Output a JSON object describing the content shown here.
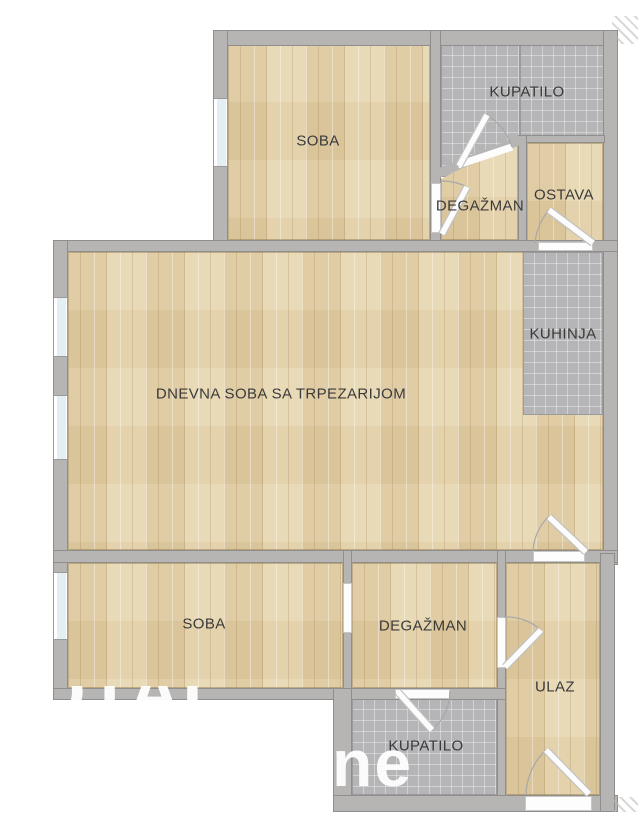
{
  "plan": {
    "rooms": {
      "soba_top": {
        "label": "SOBA"
      },
      "kupatilo_top": {
        "label": "KUPATILO"
      },
      "degazman_top": {
        "label": "DEGAŽMAN"
      },
      "ostava": {
        "label": "OSTAVA"
      },
      "kuhinja": {
        "label": "KUHINJA"
      },
      "dnevna_soba": {
        "label": "DNEVNA SOBA SA TRPEZARIJOM"
      },
      "soba_bottom": {
        "label": "SOBA"
      },
      "degazman_bottom": {
        "label": "DEGAŽMAN"
      },
      "ulaz": {
        "label": "ULAZ"
      },
      "kupatilo_bottom": {
        "label": "KUPATILO"
      }
    },
    "watermark": {
      "line1": "TOTAL",
      "line2": "ne"
    },
    "colors": {
      "wall": "#b6b5b3",
      "wood": "#e4d2ab",
      "tile": "#b5b5b7",
      "window_glass": "#e4eff3",
      "label_text": "#3a3a3a",
      "background": "#ffffff"
    }
  }
}
